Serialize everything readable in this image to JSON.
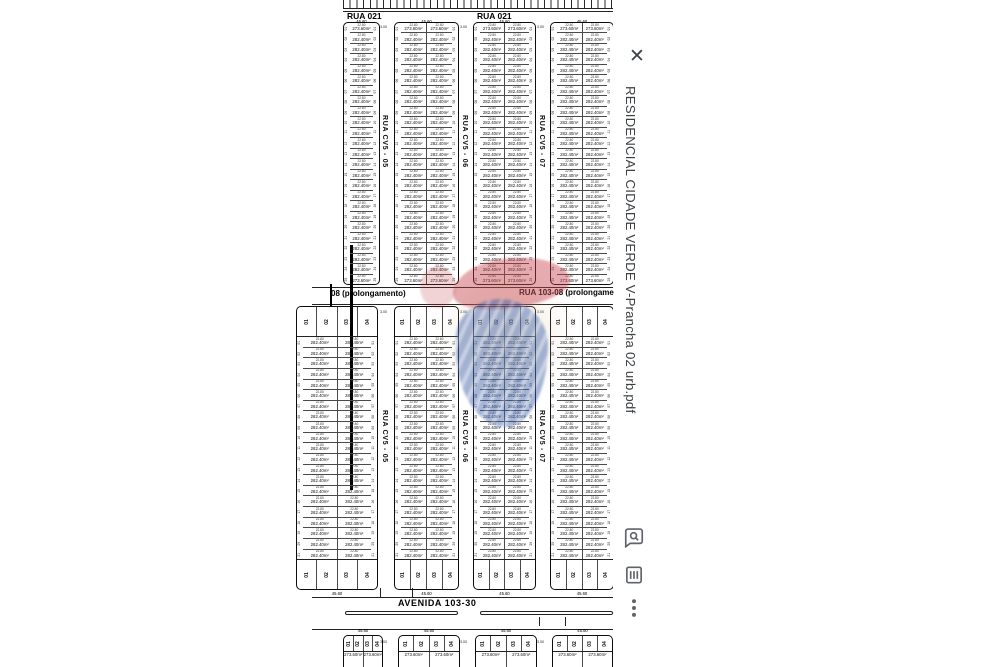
{
  "viewer": {
    "title": "RESIDENCIAL CIDADE VERDE V-Prancha 02 urb.pdf",
    "close_glyph": "✕",
    "icon_color": "#5f6368",
    "title_color": "#3c4043",
    "background": "#ffffff",
    "icons": [
      "close-icon",
      "find-in-document-icon",
      "page-list-icon",
      "overflow-menu-icon"
    ]
  },
  "plan": {
    "roads": {
      "rua021": "RUA 021",
      "rua103_left": "08 (prolongamento)",
      "rua103_right": "RUA 103-08 (prolongamento)",
      "avenida": "AVENIDA 103-30"
    },
    "streets": [
      {
        "name": "RUA CV5 - 05",
        "x": 386
      },
      {
        "name": "RUA CV5 - 06",
        "x": 466
      },
      {
        "name": "RUA CV5 - 07",
        "x": 543
      }
    ],
    "dims": {
      "lot_width": "22.80",
      "area_standard": "282.40m²",
      "area_corner": "273.60m²",
      "block_width": "45.60",
      "street_gap": "3.00"
    },
    "narrow_lots": [
      "01",
      "02",
      "03",
      "04"
    ],
    "watermark": {
      "red": "#c43a44",
      "blue": "#3b5ea9",
      "beige": "rgba(220,200,170,0.42)"
    },
    "geometry": {
      "comb": {
        "x": 343,
        "y": 0,
        "w": 271,
        "h": 8
      },
      "hlines": [
        [
          343,
          8,
          271
        ],
        [
          343,
          10.5,
          271
        ],
        [
          312,
          286.5,
          302
        ],
        [
          312,
          304,
          302
        ],
        [
          312,
          597,
          302
        ],
        [
          312,
          629,
          302
        ]
      ],
      "medians": [
        [
          345,
          611,
          113
        ],
        [
          480,
          611,
          133
        ]
      ],
      "ticks": [
        [
          380,
          588
        ],
        [
          412,
          588
        ],
        [
          539,
          617
        ],
        [
          565,
          617
        ]
      ],
      "thick_line": {
        "x": 350,
        "y": 245,
        "w": 2.5,
        "h": 245
      },
      "short_thick": {
        "x": 330,
        "y": 284,
        "w": 2,
        "h": 22
      },
      "street_label_y": [
        153,
        448
      ],
      "street_gap_label_y": [
        25,
        310,
        640
      ],
      "sections": {
        "top": {
          "y": 22,
          "h": 263,
          "rows": 25,
          "blocks": [
            {
              "x": 343,
              "w": 37,
              "cols": 1
            },
            {
              "x": 394,
              "w": 65,
              "cols": 2
            },
            {
              "x": 473,
              "w": 63,
              "cols": 2
            },
            {
              "x": 550,
              "w": 64,
              "cols": 2
            }
          ]
        },
        "mid": {
          "y": 306,
          "h": 284,
          "rows": 21,
          "narrow": 30,
          "bottom_dim_y": 591,
          "blocks": [
            {
              "x": 296,
              "w": 82,
              "cols": 2
            },
            {
              "x": 394,
              "w": 65,
              "cols": 2
            },
            {
              "x": 473,
              "w": 63,
              "cols": 2
            },
            {
              "x": 550,
              "w": 64,
              "cols": 2
            }
          ]
        },
        "bottom": {
          "y": 635,
          "h": 45,
          "narrow": 16,
          "top_dim_y": 628,
          "blocks": [
            {
              "x": 343,
              "w": 40,
              "cols": 2
            },
            {
              "x": 398,
              "w": 62,
              "cols": 2
            },
            {
              "x": 475,
              "w": 62,
              "cols": 2
            },
            {
              "x": 552,
              "w": 61,
              "cols": 2
            }
          ]
        }
      }
    }
  }
}
